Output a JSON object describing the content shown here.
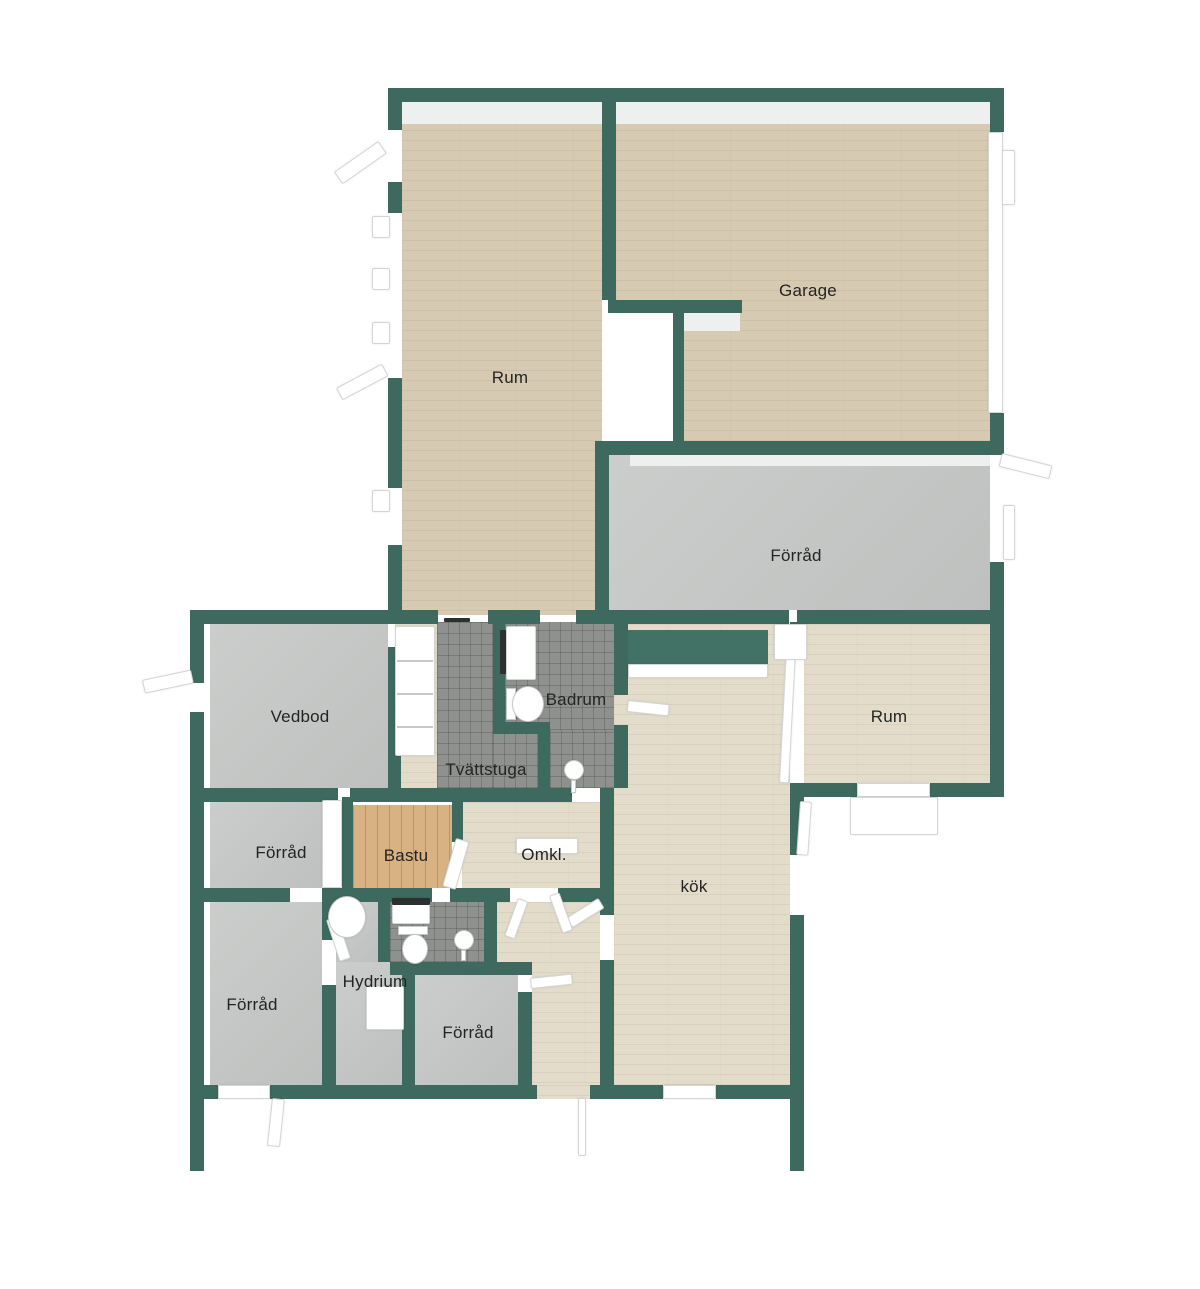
{
  "palette": {
    "wall": "#3d695e",
    "wood": "#d6cbb2",
    "wood_light": "#e3dcca",
    "concrete": "#c5c8c6",
    "tile": "#8e918e",
    "sauna": "#d9b284",
    "background": "#ffffff",
    "label_color": "#242424"
  },
  "rooms": [
    {
      "id": "rum-top",
      "label": "Rum",
      "lx": 510,
      "ly": 378
    },
    {
      "id": "garage",
      "label": "Garage",
      "lx": 808,
      "ly": 291
    },
    {
      "id": "forrad-main",
      "label": "Förråd",
      "lx": 796,
      "ly": 556
    },
    {
      "id": "vedbod",
      "label": "Vedbod",
      "lx": 300,
      "ly": 717
    },
    {
      "id": "badrum",
      "label": "Badrum",
      "lx": 576,
      "ly": 700
    },
    {
      "id": "tvattstuga",
      "label": "Tvättstuga",
      "lx": 486,
      "ly": 770
    },
    {
      "id": "rum-right",
      "label": "Rum",
      "lx": 889,
      "ly": 717
    },
    {
      "id": "forrad-left",
      "label": "Förråd",
      "lx": 281,
      "ly": 853
    },
    {
      "id": "bastu",
      "label": "Bastu",
      "lx": 406,
      "ly": 856
    },
    {
      "id": "omkl",
      "label": "Omkl.",
      "lx": 544,
      "ly": 855
    },
    {
      "id": "kok",
      "label": "kök",
      "lx": 694,
      "ly": 887
    },
    {
      "id": "forrad-bl",
      "label": "Förråd",
      "lx": 252,
      "ly": 1005
    },
    {
      "id": "hydrium",
      "label": "Hydrium",
      "lx": 375,
      "ly": 982
    },
    {
      "id": "forrad-center",
      "label": "Förråd",
      "lx": 468,
      "ly": 1033
    }
  ],
  "geometry": {
    "floors": [
      {
        "room": "rum-top",
        "mat": "wood",
        "r": [
          402,
          100,
          200,
          515
        ]
      },
      {
        "room": "garage",
        "mat": "wood",
        "r": [
          616,
          100,
          374,
          341
        ]
      },
      {
        "room": "forrad-main",
        "mat": "concrete",
        "r": [
          609,
          455,
          381,
          160
        ]
      },
      {
        "room": "vedbod",
        "mat": "concrete",
        "r": [
          210,
          622,
          178,
          166
        ]
      },
      {
        "room": "hall",
        "mat": "wood_light",
        "r": [
          395,
          622,
          42,
          166
        ]
      },
      {
        "room": "tvattstuga",
        "mat": "tile",
        "r": [
          437,
          622,
          56,
          166
        ]
      },
      {
        "room": "tvattstuga",
        "mat": "tile",
        "r": [
          493,
          734,
          45,
          54
        ]
      },
      {
        "room": "badrum",
        "mat": "tile",
        "r": [
          505,
          622,
          109,
          108
        ]
      },
      {
        "room": "badrum",
        "mat": "tile",
        "r": [
          550,
          730,
          64,
          58
        ]
      },
      {
        "room": "kok",
        "mat": "wood_light",
        "r": [
          614,
          624,
          176,
          461
        ]
      },
      {
        "room": "rum-right",
        "mat": "wood_light",
        "r": [
          804,
          624,
          186,
          159
        ]
      },
      {
        "room": "omkl",
        "mat": "wood_light",
        "r": [
          462,
          802,
          138,
          86
        ]
      },
      {
        "room": "bastu",
        "mat": "sauna",
        "r": [
          353,
          805,
          99,
          83
        ]
      },
      {
        "room": "forrad-left",
        "mat": "concrete",
        "r": [
          210,
          802,
          112,
          86
        ]
      },
      {
        "room": "forrad-bl",
        "mat": "concrete",
        "r": [
          210,
          902,
          112,
          183
        ]
      },
      {
        "room": "hydrium",
        "mat": "concrete",
        "r": [
          336,
          902,
          42,
          60
        ]
      },
      {
        "room": "hydrium",
        "mat": "concrete",
        "r": [
          336,
          962,
          66,
          123
        ]
      },
      {
        "room": "wc",
        "mat": "tile",
        "r": [
          390,
          902,
          94,
          60
        ]
      },
      {
        "room": "corridor",
        "mat": "wood_light",
        "r": [
          497,
          902,
          103,
          60
        ]
      },
      {
        "room": "corridor",
        "mat": "wood_light",
        "r": [
          532,
          962,
          68,
          123
        ]
      },
      {
        "room": "entrance-gap",
        "mat": "wood_light",
        "r": [
          537,
          1085,
          53,
          14
        ]
      },
      {
        "room": "forrad-center",
        "mat": "concrete",
        "r": [
          415,
          975,
          103,
          110
        ]
      }
    ],
    "faces": [
      {
        "n": "wall-face-top",
        "r": [
          402,
          102,
          588,
          22
        ]
      },
      {
        "n": "wall-face-forrad",
        "r": [
          630,
          455,
          360,
          11
        ]
      },
      {
        "n": "wall-face-stub",
        "r": [
          683,
          313,
          57,
          18
        ]
      }
    ],
    "plain_whites": [
      {
        "n": "garage-passage",
        "r": [
          608,
          313,
          65,
          128
        ]
      },
      {
        "n": "wall-slot",
        "r": [
          789,
          610,
          8,
          14
        ]
      }
    ],
    "walls": [
      {
        "r": [
          388,
          88,
          616,
          14
        ]
      },
      {
        "r": [
          602,
          88,
          14,
          212
        ]
      },
      {
        "r": [
          608,
          300,
          134,
          13
        ]
      },
      {
        "r": [
          673,
          313,
          11,
          128
        ]
      },
      {
        "r": [
          388,
          88,
          14,
          42
        ]
      },
      {
        "r": [
          388,
          182,
          14,
          31
        ]
      },
      {
        "r": [
          388,
          378,
          14,
          110
        ]
      },
      {
        "r": [
          388,
          545,
          14,
          65
        ]
      },
      {
        "r": [
          990,
          88,
          14,
          44
        ]
      },
      {
        "r": [
          990,
          413,
          14,
          42
        ]
      },
      {
        "r": [
          595,
          441,
          409,
          14
        ]
      },
      {
        "r": [
          595,
          441,
          14,
          183
        ]
      },
      {
        "r": [
          990,
          562,
          14,
          62
        ]
      },
      {
        "r": [
          595,
          610,
          194,
          14
        ]
      },
      {
        "r": [
          797,
          610,
          207,
          14
        ]
      },
      {
        "r": [
          388,
          610,
          50,
          14
        ]
      },
      {
        "r": [
          488,
          610,
          52,
          14
        ]
      },
      {
        "r": [
          576,
          610,
          26,
          14
        ]
      },
      {
        "r": [
          196,
          610,
          192,
          14
        ]
      },
      {
        "r": [
          190,
          610,
          14,
          73
        ]
      },
      {
        "r": [
          190,
          712,
          14,
          459
        ]
      },
      {
        "r": [
          388,
          647,
          13,
          141
        ]
      },
      {
        "r": [
          190,
          788,
          148,
          14
        ]
      },
      {
        "r": [
          350,
          788,
          222,
          14
        ]
      },
      {
        "r": [
          600,
          788,
          14,
          127
        ]
      },
      {
        "r": [
          600,
          960,
          14,
          125
        ]
      },
      {
        "r": [
          190,
          888,
          100,
          14
        ]
      },
      {
        "r": [
          322,
          888,
          110,
          14
        ]
      },
      {
        "r": [
          450,
          888,
          60,
          14
        ]
      },
      {
        "r": [
          558,
          888,
          42,
          14
        ]
      },
      {
        "r": [
          342,
          797,
          11,
          91
        ]
      },
      {
        "r": [
          452,
          793,
          11,
          49
        ]
      },
      {
        "r": [
          322,
          902,
          14,
          38
        ]
      },
      {
        "r": [
          322,
          985,
          14,
          100
        ]
      },
      {
        "r": [
          378,
          888,
          12,
          74
        ]
      },
      {
        "r": [
          484,
          888,
          13,
          74
        ]
      },
      {
        "r": [
          390,
          962,
          142,
          13
        ]
      },
      {
        "r": [
          402,
          962,
          13,
          123
        ]
      },
      {
        "r": [
          518,
          992,
          14,
          93
        ]
      },
      {
        "r": [
          493,
          610,
          12,
          120
        ]
      },
      {
        "r": [
          493,
          722,
          57,
          12
        ]
      },
      {
        "r": [
          538,
          734,
          12,
          54
        ]
      },
      {
        "r": [
          614,
          610,
          14,
          85
        ]
      },
      {
        "r": [
          614,
          725,
          14,
          63
        ]
      },
      {
        "r": [
          790,
          622,
          14,
          25
        ]
      },
      {
        "r": [
          790,
          783,
          67,
          14
        ]
      },
      {
        "r": [
          790,
          797,
          14,
          58
        ]
      },
      {
        "r": [
          790,
          915,
          14,
          256
        ]
      },
      {
        "r": [
          990,
          610,
          14,
          187
        ]
      },
      {
        "r": [
          930,
          783,
          74,
          14
        ]
      },
      {
        "r": [
          190,
          1085,
          28,
          14
        ]
      },
      {
        "r": [
          270,
          1085,
          267,
          14
        ]
      },
      {
        "r": [
          590,
          1085,
          73,
          14
        ]
      },
      {
        "r": [
          716,
          1085,
          88,
          14
        ]
      }
    ],
    "green_furniture": [
      {
        "n": "kok-wardrobe",
        "r": [
          628,
          630,
          140,
          34
        ]
      }
    ],
    "white_elements": [
      {
        "n": "garage-window-strip",
        "r": [
          988,
          132,
          15,
          281
        ],
        "rot": 0
      },
      {
        "n": "window-sill",
        "r": [
          372,
          216,
          18,
          22
        ],
        "rot": 0
      },
      {
        "n": "window-sill",
        "r": [
          372,
          268,
          18,
          22
        ],
        "rot": 0
      },
      {
        "n": "window-sill",
        "r": [
          372,
          322,
          18,
          22
        ],
        "rot": 0
      },
      {
        "n": "window-sill",
        "r": [
          372,
          490,
          18,
          22
        ],
        "rot": 0
      },
      {
        "n": "window-sill",
        "r": [
          1002,
          150,
          13,
          55
        ],
        "rot": 0
      },
      {
        "n": "window-sill",
        "r": [
          1003,
          505,
          12,
          55
        ],
        "rot": 0
      },
      {
        "n": "door-leaf-rum-exterior",
        "r": [
          334,
          172,
          54,
          15
        ],
        "rot": -35
      },
      {
        "n": "door-leaf-rum-exterior2",
        "r": [
          336,
          388,
          52,
          14
        ],
        "rot": -28
      },
      {
        "n": "door-leaf-vedbod",
        "r": [
          142,
          680,
          50,
          14
        ],
        "rot": -12
      },
      {
        "n": "door-leaf-forrad-main",
        "r": [
          1002,
          453,
          52,
          14
        ],
        "rot": 14
      },
      {
        "n": "door-leaf-badrum",
        "r": [
          628,
          700,
          42,
          12
        ],
        "rot": 6
      },
      {
        "n": "door-leaf-kok-left",
        "r": [
          566,
          918,
          38,
          12
        ],
        "rot": -32
      },
      {
        "n": "door-leaf-bastu",
        "r": [
          456,
          838,
          14,
          50
        ],
        "rot": 16
      },
      {
        "n": "door-leaf-omkl-1",
        "r": [
          518,
          898,
          11,
          40
        ],
        "rot": 20
      },
      {
        "n": "door-leaf-omkl-2",
        "r": [
          549,
          896,
          11,
          40
        ],
        "rot": -20
      },
      {
        "n": "door-leaf-hydrium",
        "r": [
          326,
          920,
          12,
          44
        ],
        "rot": -18
      },
      {
        "n": "door-leaf-forrad-center",
        "r": [
          530,
          978,
          42,
          11
        ],
        "rot": -6
      },
      {
        "n": "door-leaf-kok-right",
        "r": [
          800,
          801,
          12,
          54
        ],
        "rot": 4
      },
      {
        "n": "door-leaf-rum-right",
        "r": [
          786,
          650,
          10,
          133
        ],
        "rot": 3
      },
      {
        "n": "door-frame-rum-right",
        "r": [
          774,
          624,
          33,
          36
        ],
        "rot": 0
      },
      {
        "n": "door-block-bottom-left",
        "r": [
          218,
          1085,
          52,
          14
        ],
        "rot": 0
      },
      {
        "n": "door-leaf-bottom-left",
        "r": [
          272,
          1098,
          13,
          48
        ],
        "rot": 6
      },
      {
        "n": "door-leaf-entrance",
        "r": [
          578,
          1098,
          8,
          58
        ],
        "rot": 0
      },
      {
        "n": "door-block-kok-bottom",
        "r": [
          663,
          1085,
          53,
          14
        ],
        "rot": 0
      },
      {
        "n": "window-block-rum-right",
        "r": [
          857,
          783,
          73,
          14
        ],
        "rot": 0
      },
      {
        "n": "terrace-rum-right",
        "r": [
          850,
          797,
          88,
          38
        ],
        "rot": 0
      },
      {
        "n": "closet-hall",
        "r": [
          395,
          626,
          40,
          130
        ],
        "rot": 0
      },
      {
        "n": "bench-omkl",
        "r": [
          516,
          838,
          62,
          16
        ],
        "rot": 0
      },
      {
        "n": "chest-hydrium",
        "r": [
          366,
          986,
          38,
          44
        ],
        "rot": 0
      },
      {
        "n": "door-strip-forrad-left",
        "r": [
          322,
          800,
          20,
          88
        ],
        "rot": 0
      },
      {
        "n": "kok-wardrobe-front",
        "r": [
          628,
          664,
          140,
          14
        ],
        "rot": 0
      },
      {
        "n": "sink-badrum",
        "r": [
          506,
          626,
          30,
          54
        ],
        "rot": 0
      },
      {
        "n": "sink-wc",
        "r": [
          392,
          898,
          38,
          26
        ],
        "rot": 0
      }
    ],
    "gray_lines": [
      {
        "n": "closet-divider",
        "r": [
          397,
          660,
          36,
          2
        ]
      },
      {
        "n": "closet-divider",
        "r": [
          397,
          693,
          36,
          2
        ]
      },
      {
        "n": "closet-divider",
        "r": [
          397,
          726,
          36,
          2
        ]
      }
    ],
    "dark_elements": [
      {
        "n": "radiator-badrum",
        "r": [
          500,
          630,
          6,
          44
        ]
      },
      {
        "n": "door-marker",
        "r": [
          444,
          618,
          26,
          4
        ]
      },
      {
        "n": "sink-wc-top",
        "r": [
          392,
          898,
          38,
          7
        ]
      }
    ],
    "shapes": [
      {
        "n": "toilet-tank-badrum",
        "kind": "rect",
        "r": [
          506,
          688,
          10,
          32
        ]
      },
      {
        "n": "toilet-bowl-badrum",
        "kind": "ellipse",
        "r": [
          512,
          686,
          32,
          36
        ]
      },
      {
        "n": "toilet-tank-wc",
        "kind": "rect",
        "r": [
          398,
          926,
          30,
          9
        ]
      },
      {
        "n": "toilet-bowl-wc",
        "kind": "ellipse",
        "r": [
          402,
          934,
          26,
          30
        ]
      },
      {
        "n": "shower-head-badrum",
        "kind": "ellipse",
        "r": [
          564,
          760,
          20,
          20
        ]
      },
      {
        "n": "shower-stem-badrum",
        "kind": "rect",
        "r": [
          571,
          780,
          5,
          13
        ]
      },
      {
        "n": "shower-head-wc",
        "kind": "ellipse",
        "r": [
          454,
          930,
          20,
          20
        ]
      },
      {
        "n": "shower-stem-wc",
        "kind": "rect",
        "r": [
          461,
          950,
          5,
          11
        ]
      },
      {
        "n": "water-heater",
        "kind": "ellipse",
        "r": [
          328,
          896,
          38,
          42
        ]
      }
    ]
  }
}
